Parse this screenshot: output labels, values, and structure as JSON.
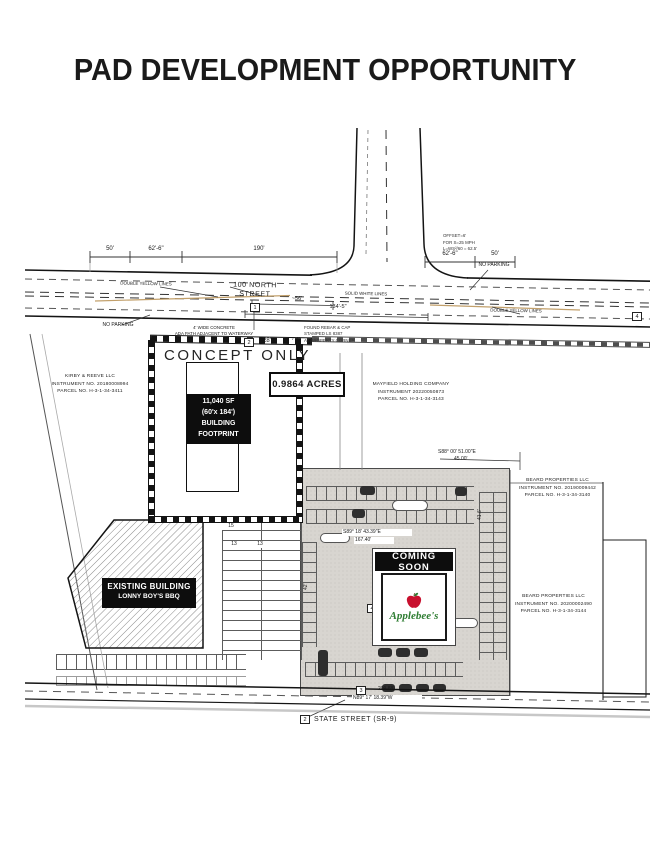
{
  "title": "PAD DEVELOPMENT OPPORTUNITY",
  "roads": {
    "north": "100 NORTH STREET",
    "state": "STATE STREET (SR-9)"
  },
  "ann": {
    "dyl_left": "DOUBLE YELLOW LINES",
    "dyl_right": "DOUBLE YELLOW LINES",
    "swl": "SOLID WHITE LINES",
    "np_left": "NO PARKING",
    "np_right": "NO PARKING",
    "ada1": "4' WIDE CONCRETE",
    "ada2": "ADA PATH ADJACENT TO WATERWAY",
    "off1": "OFFSET=6'",
    "off2": "FOR S=25 MPH",
    "off3": "L=WS²/60 = 62.5'",
    "rebar1": "FOUND REBAR & CAP",
    "rebar2": "STAMPED LS 8387",
    "rebar3": "AT PROPERTY CORNER",
    "concept": "CONCEPT ONLY"
  },
  "dims": {
    "d50a": "50'",
    "d62a": "62'-6\"",
    "d190": "190'",
    "d62b": "62'-6\"",
    "d50b": "50'",
    "d56": "~56'",
    "d134": "134'-5\"",
    "d28": "28'",
    "d7": "7'-6\"",
    "b1": "S88° 00' 51.00\"E",
    "b1v": "45.00'",
    "b2": "S89° 18' 43.39\"E",
    "b2v": "167.40'",
    "b3": "N89° 17' 18.39\"W",
    "b3v": "209.88'",
    "r42": "42'",
    "r41": "41.6'"
  },
  "parcels": {
    "kirby": {
      "name": "KIRBY & REEVE LLC",
      "instr": "INSTRUMENT NO. 20180008994",
      "parcel": "PARCEL NO. H-3-1-34-3411"
    },
    "mayfield": {
      "name": "MAYFIELD HOLDING COMPANY",
      "instr": "INSTRUMENT 20220050873",
      "parcel": "PARCEL NO. H-3-1-34-3143"
    },
    "beard_n": {
      "name": "BEARD PROPERTIES LLC",
      "instr": "INSTRUMENT NO. 20190009442",
      "parcel": "PARCEL NO. H-3-1-34-3140"
    },
    "beard_s": {
      "name": "BEARD PROPERTIES LLC",
      "instr": "INSTRUMENT NO. 20200002490",
      "parcel": "PARCEL NO. H-3-1-34-3144"
    }
  },
  "pad": {
    "acres": "0.9864 ACRES",
    "fp1": "11,040 SF",
    "fp2": "(60'x 184')",
    "fp3": "BUILDING",
    "fp4": "FOOTPRINT"
  },
  "existing": {
    "l1": "EXISTING BUILDING",
    "l2": "LONNY BOY'S BBQ"
  },
  "coming": {
    "banner": "COMING SOON",
    "brand": "Applebee's"
  },
  "markers": {
    "a": "1",
    "b": "2",
    "c": "4",
    "d": "3",
    "e": "2",
    "f": "4"
  },
  "stalls": {
    "n15": "15",
    "n13a": "13",
    "n13b": "13"
  },
  "colors": {
    "ink": "#1a1a1a",
    "double_yellow": "#c2a06b",
    "lot_gray": "#d8d5d0",
    "apple_red": "#c8102e",
    "apple_green": "#2e7d32"
  }
}
